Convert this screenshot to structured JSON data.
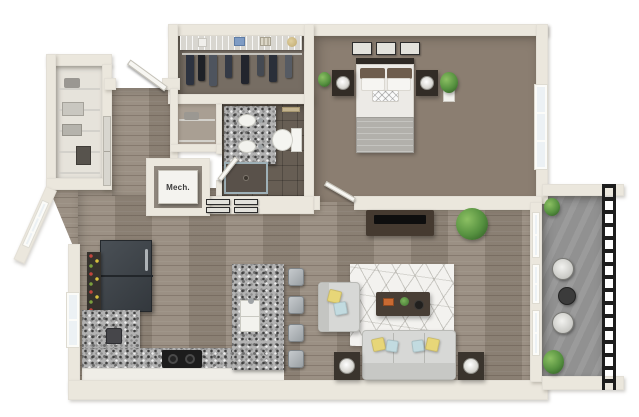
{
  "scene": {
    "type": "3d-floor-plan-render",
    "view": "top-down isometric",
    "mech_label": "Mech."
  },
  "colors": {
    "wall": "#ebe7dd",
    "wood-floor": "#95897c",
    "carpet": "#8b7e71",
    "closet-floor": "#766d63",
    "tile-floor": "#675e54",
    "concrete": "#919191",
    "granite-base": "#b3b3b3",
    "window-glass": "#ecf1f4",
    "sofa-gray": "#d7d8d6",
    "pillow-yellow": "#e7d678",
    "pillow-blue": "#c2dbe0",
    "furniture-dark": "#453a30",
    "plant-green": "#55903f",
    "railing-black": "#1d1d1d",
    "rug-white": "#f3f2ef",
    "appliance-dark": "#3c4146",
    "bed-duvet": "#eceae6",
    "bed-blanket": "#b2b0ab",
    "bed-brown-pillow": "#6e5d4d",
    "door-gray": "#d8d6cf",
    "towel-tan": "#c3b38e"
  },
  "rooms": [
    {
      "name": "bedroom",
      "floor": "carpet",
      "contents": [
        "bed",
        "headboard",
        "nightstand-left",
        "nightstand-right",
        "table-lamp-left",
        "table-lamp-right",
        "wall-frames-x3",
        "potted-plant-small",
        "potted-plant-tall",
        "window",
        "door"
      ]
    },
    {
      "name": "walk-in-closet",
      "floor": "carpet-dark",
      "contents": [
        "wire-shelf",
        "hanging-rod",
        "hanging-clothes-x8",
        "storage-boxes",
        "hat"
      ]
    },
    {
      "name": "bathroom",
      "floor": "tile",
      "contents": [
        "double-sink-granite-vanity",
        "toilet",
        "towel-bar",
        "walk-in-shower",
        "door"
      ]
    },
    {
      "name": "linen-closet",
      "contents": [
        "wire-shelves"
      ]
    },
    {
      "name": "pantry-closet",
      "contents": [
        "wire-shelves",
        "baskets",
        "gray-double-doors"
      ]
    },
    {
      "name": "entry-hall",
      "floor": "wood",
      "contents": [
        "entry-door-open"
      ]
    },
    {
      "name": "mechanical-closet",
      "label": "Mech.",
      "contents": [
        "mechanical-unit"
      ]
    },
    {
      "name": "kitchen",
      "floor": "wood",
      "contents": [
        "refrigerator",
        "wine-rack",
        "granite-l-counter",
        "granite-island-with-sink",
        "cooktop",
        "coffee-maker",
        "bar-stools-x4",
        "window",
        "wall-frames-x4"
      ]
    },
    {
      "name": "living-room",
      "floor": "wood",
      "contents": [
        "area-rug",
        "sofa",
        "throw-pillows",
        "armchair",
        "coffee-table",
        "books",
        "tv-console",
        "tv",
        "side-tables-with-lamps-x2",
        "potted-plant",
        "windows-x2",
        "balcony-door"
      ]
    },
    {
      "name": "balcony",
      "floor": "concrete",
      "contents": [
        "metal-railing",
        "bistro-table",
        "bistro-chairs-x2",
        "potted-plants-x2"
      ]
    }
  ]
}
